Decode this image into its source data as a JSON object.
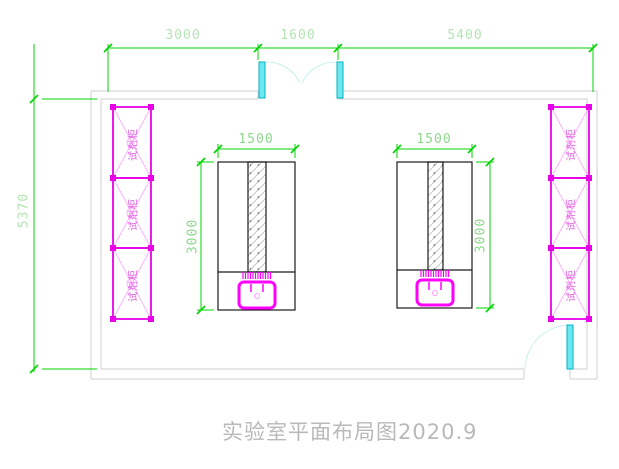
{
  "drawing": {
    "title": "实验室平面布局图2020.9",
    "dimensions": {
      "top": [
        "3000",
        "1600",
        "5400"
      ],
      "left_wall": "5370",
      "bench1_width": "1500",
      "bench1_depth": "3000",
      "bench2_width": "1500",
      "bench2_depth": "3000"
    },
    "cabinets": {
      "label": "试剂柜",
      "left_count": 3,
      "right_count": 3
    },
    "colors": {
      "dimension_line": "#00d400",
      "dimension_text_pale": "#b4e4b4",
      "dimension_text": "#8ed88e",
      "wall": "#cfcfcf",
      "cabinet": "#e800e8",
      "cabinet_text": "#e05ce0",
      "door_leaf_fill": "#6ee8f0",
      "door_leaf_stroke": "#00b4c0",
      "door_swing": "#c9f0ec",
      "sink": "#ff00ff",
      "bench_outline": "#1a1a1a",
      "title_text": "#b9b9b9"
    }
  }
}
